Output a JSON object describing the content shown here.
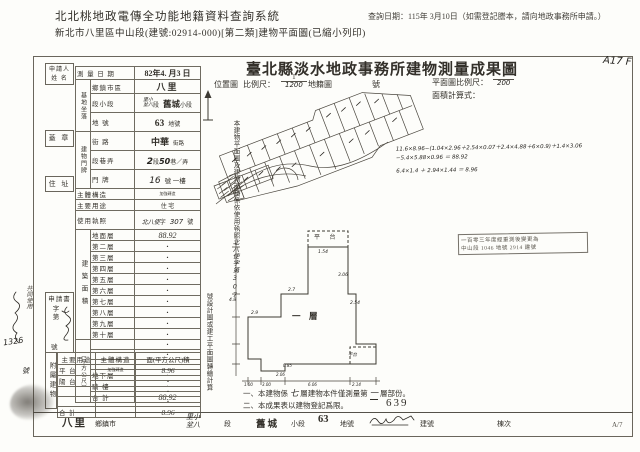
{
  "header": {
    "system_title": "北北桃地政電傳全功能地籍資料查詢系統",
    "query_date": "查詢日期：115年 3月10日（如需登記謄本，請向地政事務所申請。）",
    "subtitle": "新北市八里區中山段(建號:02914-000)[第二類]建物平面圖(已縮小列印)"
  },
  "doc": {
    "title": "臺北縣淡水地政事務所建物測量成果圖",
    "corner_note": "A17 F",
    "page_no": "A/7",
    "old_build_no": "639"
  },
  "scale": {
    "location_label": "位置圖",
    "ratio_label": "比例尺：",
    "num": "1",
    "den": "1200",
    "cadastre_label": "地籍圖",
    "no_label": "號",
    "plan_label": "平面圖比例尺：",
    "plan_num": "1",
    "plan_den": "200",
    "calc_label": "面積計算式："
  },
  "applicant": {
    "label1": "申請人",
    "label2": "姓  名",
    "seal": "蓋  章",
    "address": "住  址"
  },
  "fields": {
    "survey_date_label": "測 量 日 期",
    "survey_date_value": "82年4. 月3  日",
    "site_group": "基地坐落",
    "township_label": "鄉鎮市區",
    "township_value": "八里",
    "section_label": "段小段",
    "section_hw_l1": "里小",
    "section_hw_l2": "坌八",
    "section_mid": "段",
    "section_value": "舊城",
    "section_suffix": "小段",
    "lot_label": "地  號",
    "lot_value": "63",
    "lot_suffix": "地號",
    "building_group": "建物門牌",
    "street_label": "街  路",
    "street_value": "中華",
    "street_suffix": "街路",
    "lane_label": "段巷弄",
    "lane_hw1": "2",
    "lane_p1": "段",
    "lane_hw2": "50",
    "lane_p2": "巷／弄",
    "door_label": "門  牌",
    "door_hw": "16",
    "door_p": "號 一樓",
    "structure_label": "主體構造",
    "structure_value": "加強磚造",
    "usage_label": "主要用途",
    "usage_value": "住 宅",
    "license_label": "使用執照",
    "license_hw1": "北八使",
    "license_p1": "字",
    "license_hw2": "307",
    "license_p2": "號"
  },
  "floor_area": {
    "group": "建築面積",
    "unit": "（平方公尺）",
    "rows": [
      {
        "label": "地面層",
        "value": "88.92"
      },
      {
        "label": "第二層",
        "value": "・"
      },
      {
        "label": "第三層",
        "value": "・"
      },
      {
        "label": "第四層",
        "value": "・"
      },
      {
        "label": "第五層",
        "value": "・"
      },
      {
        "label": "第六層",
        "value": "・"
      },
      {
        "label": "第七層",
        "value": "・"
      },
      {
        "label": "第八層",
        "value": "・"
      },
      {
        "label": "第九層",
        "value": "・"
      },
      {
        "label": "第十層",
        "value": "・"
      },
      {
        "label": "",
        "value": "・"
      },
      {
        "label": "",
        "value": "・"
      },
      {
        "label": "",
        "value": "・"
      },
      {
        "label": "地下層",
        "value": "・"
      },
      {
        "label": "騎  樓",
        "value": "・"
      },
      {
        "label": "合  計",
        "value": "88.92"
      }
    ]
  },
  "attached": {
    "group": "附屬建物",
    "headers": [
      "主要用途",
      "主體構造",
      "面(平方公尺)積"
    ],
    "rows": [
      {
        "use": "平  台",
        "structure": "加強磚造",
        "area": "8.96"
      },
      {
        "use": "陽  台",
        "structure": "",
        "area": "・"
      },
      {
        "use": "",
        "structure": "",
        "area": "・"
      },
      {
        "use": "",
        "structure": "",
        "area": "・"
      },
      {
        "use": "合  計",
        "structure": "",
        "area": "8.96"
      }
    ]
  },
  "application": {
    "label": "申請書",
    "no_p1": "字",
    "no_p2": "第",
    "no_p3": "號"
  },
  "vertical_note": {
    "part1": "本建物平面圖及建物面積係依使用執照",
    "hw": "北八使字第307",
    "part2": "號設計圖或建工平面圖轉繪計算"
  },
  "calc_lines": [
    "11.6×8.96−(1.04×2.96＋2.54×0.07＋2.4×4.88＋6×0.9)＋1.4×3.06",
    "−5.4×5.88×0.96 ＝ 88.92",
    "6.4×1.4 ＋ 2.94×1.44 ＝ 8.96"
  ],
  "stamp": {
    "line1": "一百零三年度經重測後變更為",
    "line2": "中山段 1046 地號 2914 建號"
  },
  "plan": {
    "top_platform": "平 台",
    "level": "一　層",
    "bottom_platform": "平台",
    "dims": {
      "d1": "1.54",
      "d2": "3.06",
      "d3": "2.54",
      "d4": "2.7",
      "d5": "2.9",
      "d6": "0.85",
      "d7": "2.06",
      "d8": "4.8",
      "b1": "1.00",
      "b2": "3.00",
      "b3": "6.06",
      "b4": "2.14"
    }
  },
  "notes": {
    "n1_pre": "一、本建物係",
    "n1_hw1": "七",
    "n1_mid": "層建物本件僅測量第",
    "n1_hw2": "一",
    "n1_post": "層部份。",
    "n2": "二、本成果表以建物登記爲限。"
  },
  "strip": {
    "township": "八里",
    "township_label": "鄉鎮市",
    "hw_l1": "里小",
    "hw_l2": "坌八",
    "seg": "段",
    "section": "舊城",
    "section_label": "小段",
    "lot": "63",
    "lot_label": "地號",
    "build_label": "建號",
    "unit_label": "棟次"
  },
  "margin": {
    "note1": "共同使用",
    "note2": "1326",
    "note3": "號"
  },
  "colors": {
    "ink": "#33302a",
    "line": "#6f6b60",
    "hw_ink": "#262420",
    "stamp_ink": "#5a564d"
  }
}
